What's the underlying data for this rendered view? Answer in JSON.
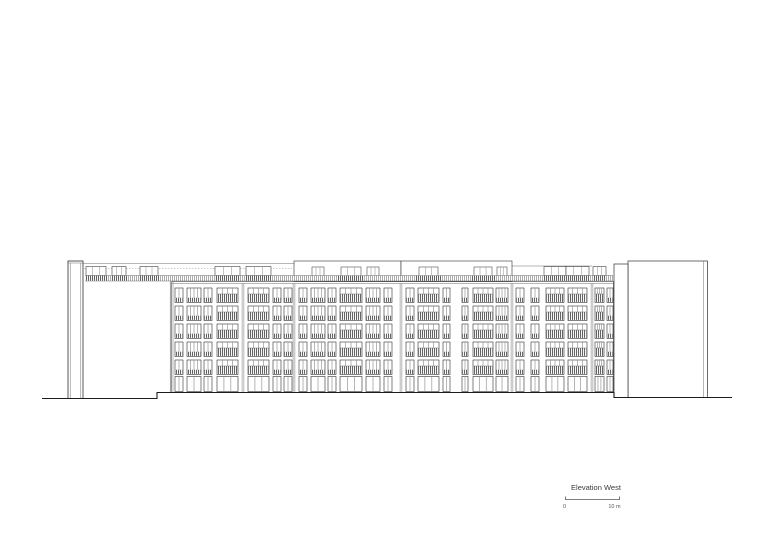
{
  "drawing": {
    "title": "Elevation West",
    "scale_bar": {
      "zero_label": "0",
      "max_label": "10 m"
    },
    "colors": {
      "bg": "#ffffff",
      "line": "#2f2f2f",
      "light": "#6e6e6e",
      "faint": "#9a9a9a",
      "ground": "#1c1c1c",
      "hatch": "#8a8a8a",
      "hatch_dark": "#474747",
      "label_text": "#3a3a3a",
      "scale_text": "#555555"
    },
    "building": {
      "ground_path": [
        [
          42,
          398.5
        ],
        [
          157,
          398.5
        ],
        [
          157,
          392.5
        ],
        [
          614,
          392.5
        ],
        [
          614,
          397.5
        ],
        [
          732,
          397.5
        ]
      ],
      "left_pilaster": {
        "x": 68,
        "y": 261,
        "w": 15,
        "h": 137.5
      },
      "left_wall": {
        "x": 83,
        "x2": 172,
        "roofline_y": 263.5,
        "roofline_x2": 294,
        "dash_y": 268.5,
        "boxes": [
          [
            86,
            20
          ],
          [
            112,
            14
          ],
          [
            140,
            18
          ]
        ]
      },
      "roofline_right": {
        "x1": 512,
        "x2": 592,
        "y": 266
      },
      "railing": {
        "x": 85,
        "x2": 613,
        "y": 275.5,
        "h": 5.5
      },
      "facade": {
        "x": 172,
        "x2": 614,
        "top_y1": 281.5,
        "top_y2": 283.5,
        "bottom": 392.5,
        "rows_y": [
          288,
          306,
          324,
          342,
          360
        ],
        "row_h": 14.5,
        "ground_y": 376.5,
        "ground_h": 15,
        "floors": 6,
        "sections": [
          {
            "x": 172,
            "w": 71,
            "penthouse": false,
            "cols": [
              [
                3,
                8,
                "n"
              ],
              [
                15,
                14,
                "p"
              ],
              [
                32,
                8,
                "n"
              ],
              [
                45,
                21,
                "b"
              ]
            ]
          },
          {
            "x": 243,
            "w": 51,
            "penthouse": false,
            "cols": [
              [
                5,
                21,
                "b"
              ],
              [
                30,
                8,
                "n"
              ],
              [
                41,
                8,
                "n"
              ]
            ]
          },
          {
            "x": 294,
            "w": 107,
            "penthouse": true,
            "cols": [
              [
                5,
                8,
                "n"
              ],
              [
                17,
                14,
                "p"
              ],
              [
                34,
                8,
                "n"
              ],
              [
                46,
                22,
                "b"
              ],
              [
                72,
                14,
                "p"
              ],
              [
                90,
                8,
                "n"
              ]
            ]
          },
          {
            "x": 401,
            "w": 111,
            "penthouse": true,
            "cols": [
              [
                5,
                8,
                "n"
              ],
              [
                17,
                21,
                "b"
              ],
              [
                42,
                7,
                "n"
              ],
              [
                61,
                6,
                "n"
              ],
              [
                72,
                20,
                "b"
              ],
              [
                95,
                12,
                "p"
              ]
            ]
          },
          {
            "x": 512,
            "w": 80,
            "penthouse": false,
            "cols": [
              [
                4,
                8,
                "n"
              ],
              [
                19,
                8,
                "n"
              ],
              [
                34,
                18,
                "b"
              ],
              [
                56,
                19,
                "b"
              ]
            ]
          },
          {
            "x": 592,
            "w": 22,
            "penthouse": false,
            "cols": [
              [
                3,
                9,
                "b"
              ],
              [
                15,
                6,
                "n"
              ]
            ]
          }
        ],
        "penthouse_top": 261
      },
      "stair_block": {
        "x": 614,
        "w": 14,
        "top": 264,
        "bottom": 397.5
      },
      "right_building": {
        "x": 628,
        "x2": 707.5,
        "top": 261,
        "bottom": 397.5,
        "inner_edge_x": 703.5
      }
    },
    "annotation": {
      "title_x": 596,
      "title_y": 490,
      "title_size": 7.5,
      "bar_x1": 565.5,
      "bar_x2": 619.5,
      "bar_y": 499.5,
      "tick_h": 3,
      "zero_x": 564.5,
      "max_x": 614.5,
      "labels_y": 508,
      "label_size": 5.5
    }
  }
}
